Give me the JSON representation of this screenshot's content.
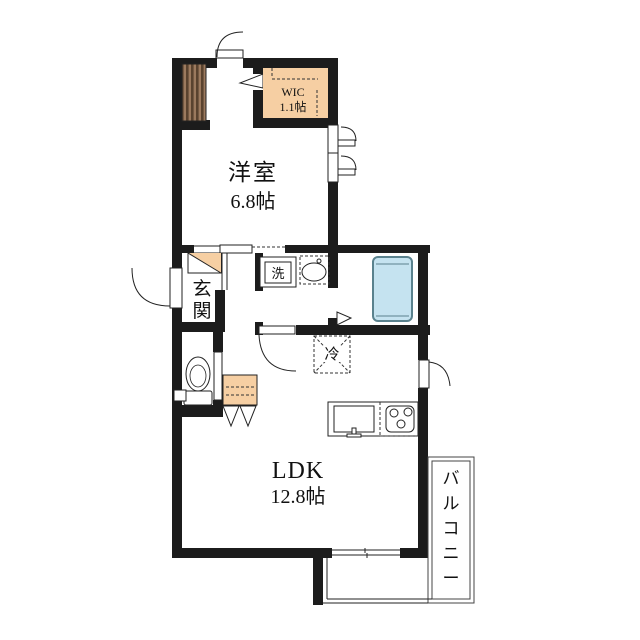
{
  "plan": {
    "type": "floorplan",
    "title": "1LDK apartment floor plan",
    "rooms": {
      "bedroom": {
        "label": "洋室",
        "size": "6.8帖"
      },
      "wic": {
        "label": "WIC",
        "size": "1.1帖"
      },
      "entrance": {
        "label": "玄関",
        "chars": [
          "玄",
          "関"
        ]
      },
      "ldk": {
        "label": "LDK",
        "size": "12.8帖"
      },
      "balcony": {
        "label": "バルコニー",
        "chars": [
          "バ",
          "ル",
          "コ",
          "ニ",
          "ー"
        ]
      }
    },
    "fixtures": {
      "washing_machine": {
        "label": "洗"
      },
      "refrigerator": {
        "label": "冷"
      }
    },
    "colors": {
      "wall": "#1c1c1c",
      "closet_fill": "#f6cfa3",
      "tub_fill": "#c5e3f0",
      "tub_stroke": "#5a828e",
      "stairs_fill": "#9c7a5e",
      "stairs_stripe": "#5a432f",
      "line": "#222222",
      "background": "#ffffff"
    }
  }
}
